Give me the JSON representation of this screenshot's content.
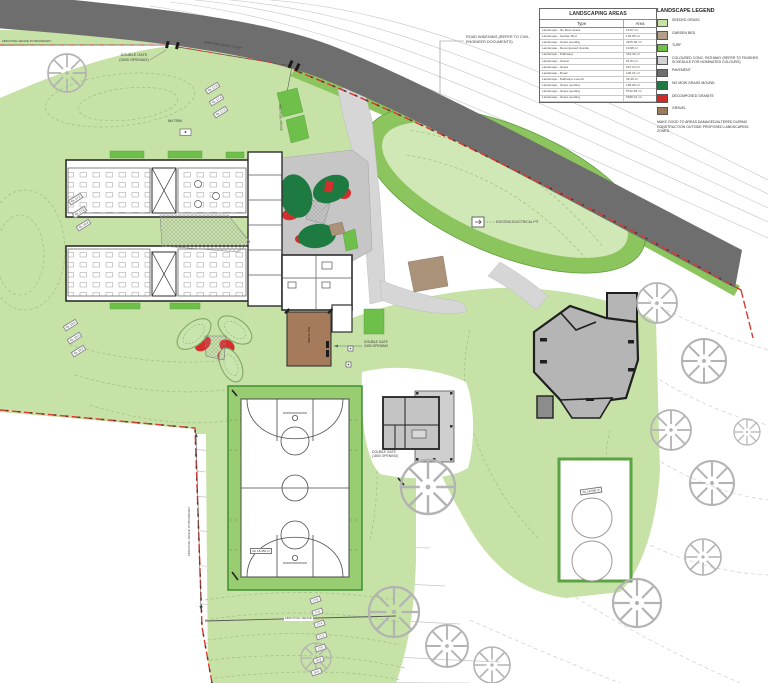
{
  "areas_table": {
    "title": "LANDSCAPING AREAS",
    "columns": {
      "type": "Type",
      "area": "Area"
    },
    "rows": [
      {
        "type": "Landscape - No Mow Grass",
        "area": "19.07 m²"
      },
      {
        "type": "Landscape - Garden Bed",
        "area": "136.85 m²"
      },
      {
        "type": "Landscape - Grass seeding",
        "area": "4975.06 m²"
      },
      {
        "type": "Landscape - Decomposed Granite",
        "area": "19.98 m²"
      },
      {
        "type": "Landscape - Pathways",
        "area": "316.46 m²"
      },
      {
        "type": "Landscape - Gravel",
        "area": "61.84 m²"
      },
      {
        "type": "Landscape - Grass",
        "area": "927.10 m²"
      },
      {
        "type": "Landscape - Road",
        "area": "100.21 m²"
      },
      {
        "type": "Landscape - Pathways council",
        "area": "36.45 m²"
      },
      {
        "type": "Landscape - Grass seeding",
        "area": "195.98 m²"
      },
      {
        "type": "Landscape - Grass seeding",
        "area": "5732.83 m²"
      },
      {
        "type": "Landscape - Grass seeding",
        "area": "5268.16 m²"
      }
    ]
  },
  "legend": {
    "title": "LANDSCAPE LEGEND",
    "items": [
      {
        "label": "SEEDED GRASS",
        "color": "#c7e2a6"
      },
      {
        "label": "GARDEN BED",
        "color": "#b3a089"
      },
      {
        "label": "TURF",
        "color": "#6fc04a"
      },
      {
        "label": "COLOURED CONC. PATHWAY (REFER TO FINISHES SCHEDULE FOR NOMINATED COLOURS)",
        "color": "#d2d2d2"
      },
      {
        "label": "PAVEMENT",
        "color": "#6f6f6f"
      },
      {
        "label": "NO MOW GRASS MOUND",
        "color": "#1d7a40"
      },
      {
        "label": "DECOMPOSED GRANITE",
        "color": "#cf2b27"
      },
      {
        "label": "GRAVEL",
        "color": "#9c7a5c"
      }
    ],
    "note": "MAKE GOOD TO AREAS DAMAGED/ALTERED DURING CONSTRUCTION OUTSIDE PROPOSED LANDSCAPING ZONES"
  },
  "labels": {
    "road_widening": "ROAD WIDENING (REFER TO CIVIL\nENGINEER DOCUMENTS)",
    "double_gate_3000": "DOUBLE GATE\n(3000 OPENING)",
    "double_gate_2400": "DOUBLE GATE\n2400 OPENING",
    "double_gate_1800": "DOUBLE GATE\n(1800 OPENING)",
    "existing_electrical_pit": "EXISTING ELECTRICAL PIT",
    "fence_to_boundary_top": "1800 POOL FENCE TO BOUNDARY",
    "new_pool_fence": "NEW POOL FENCE TO BDY",
    "fence_along_path": "1800 POOL FENCE",
    "fence_to_boundary_left": "1800 POOL FENCE TO BOUNDARY",
    "pool_fence_bottom": "1800 POOL FENCE",
    "trim": "6M TRIM",
    "bin_store": "BIN STORE",
    "tank_level": "RL 19.600 m",
    "court_level": "RL 18.450 m"
  },
  "levels": {
    "mound_nw": [
      "RL 17.2",
      "RL 17.0",
      "RL 16.8"
    ],
    "mound_n": [
      "RL 17.6",
      "RL 17.4",
      "RL 17.2"
    ],
    "edge_w": [
      "RL 16.6",
      "RL 16.4",
      "RL 16.2"
    ],
    "slope_s": [
      "17.8",
      "17.6",
      "17.4",
      "17.2",
      "17.0",
      "16.8",
      "16.6"
    ]
  }
}
